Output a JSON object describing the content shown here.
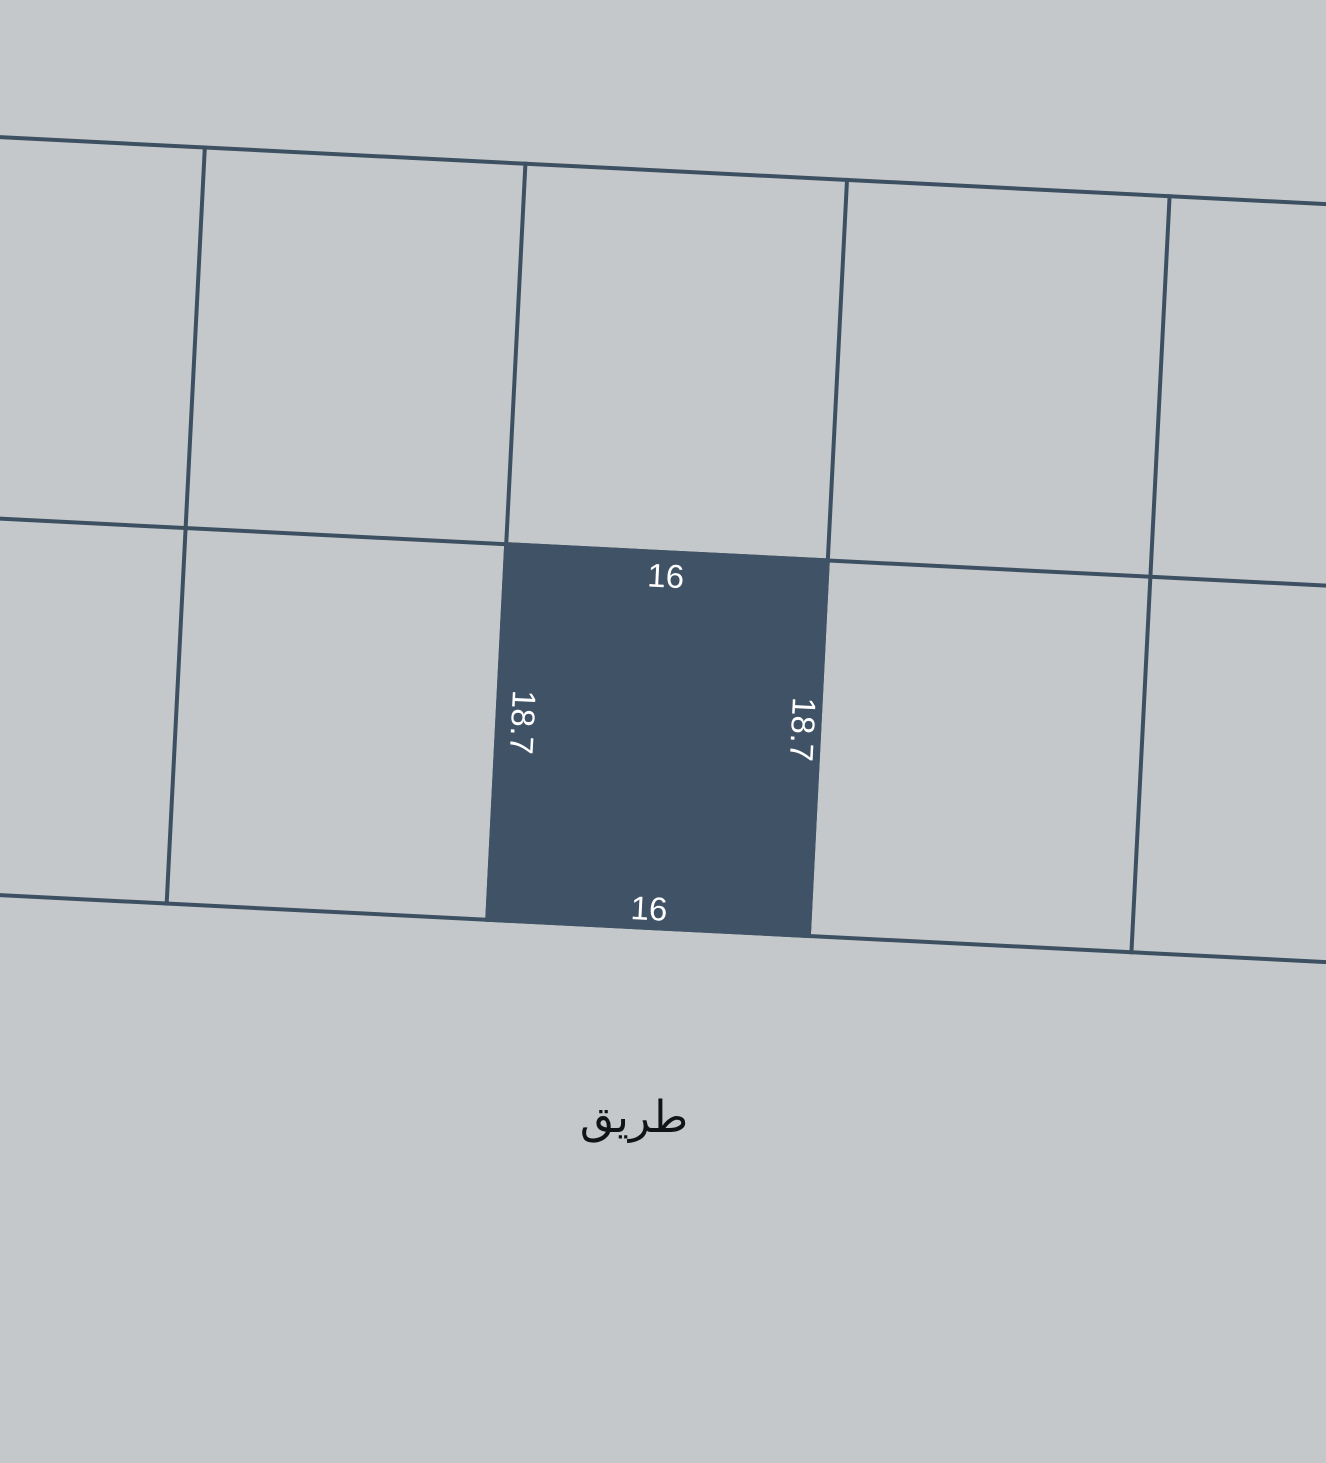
{
  "theme": {
    "bg-color": "#c4c8cb",
    "line-color": "#3d5062",
    "plot-fill": "#405266",
    "dim-text-color": "#ffffff",
    "road-text-color": "#111417"
  },
  "map": {
    "selected_plot": {
      "width_top": "16",
      "width_bottom": "16",
      "depth_left": "18.7",
      "depth_right": "18.7"
    },
    "road_label": "طريق"
  }
}
